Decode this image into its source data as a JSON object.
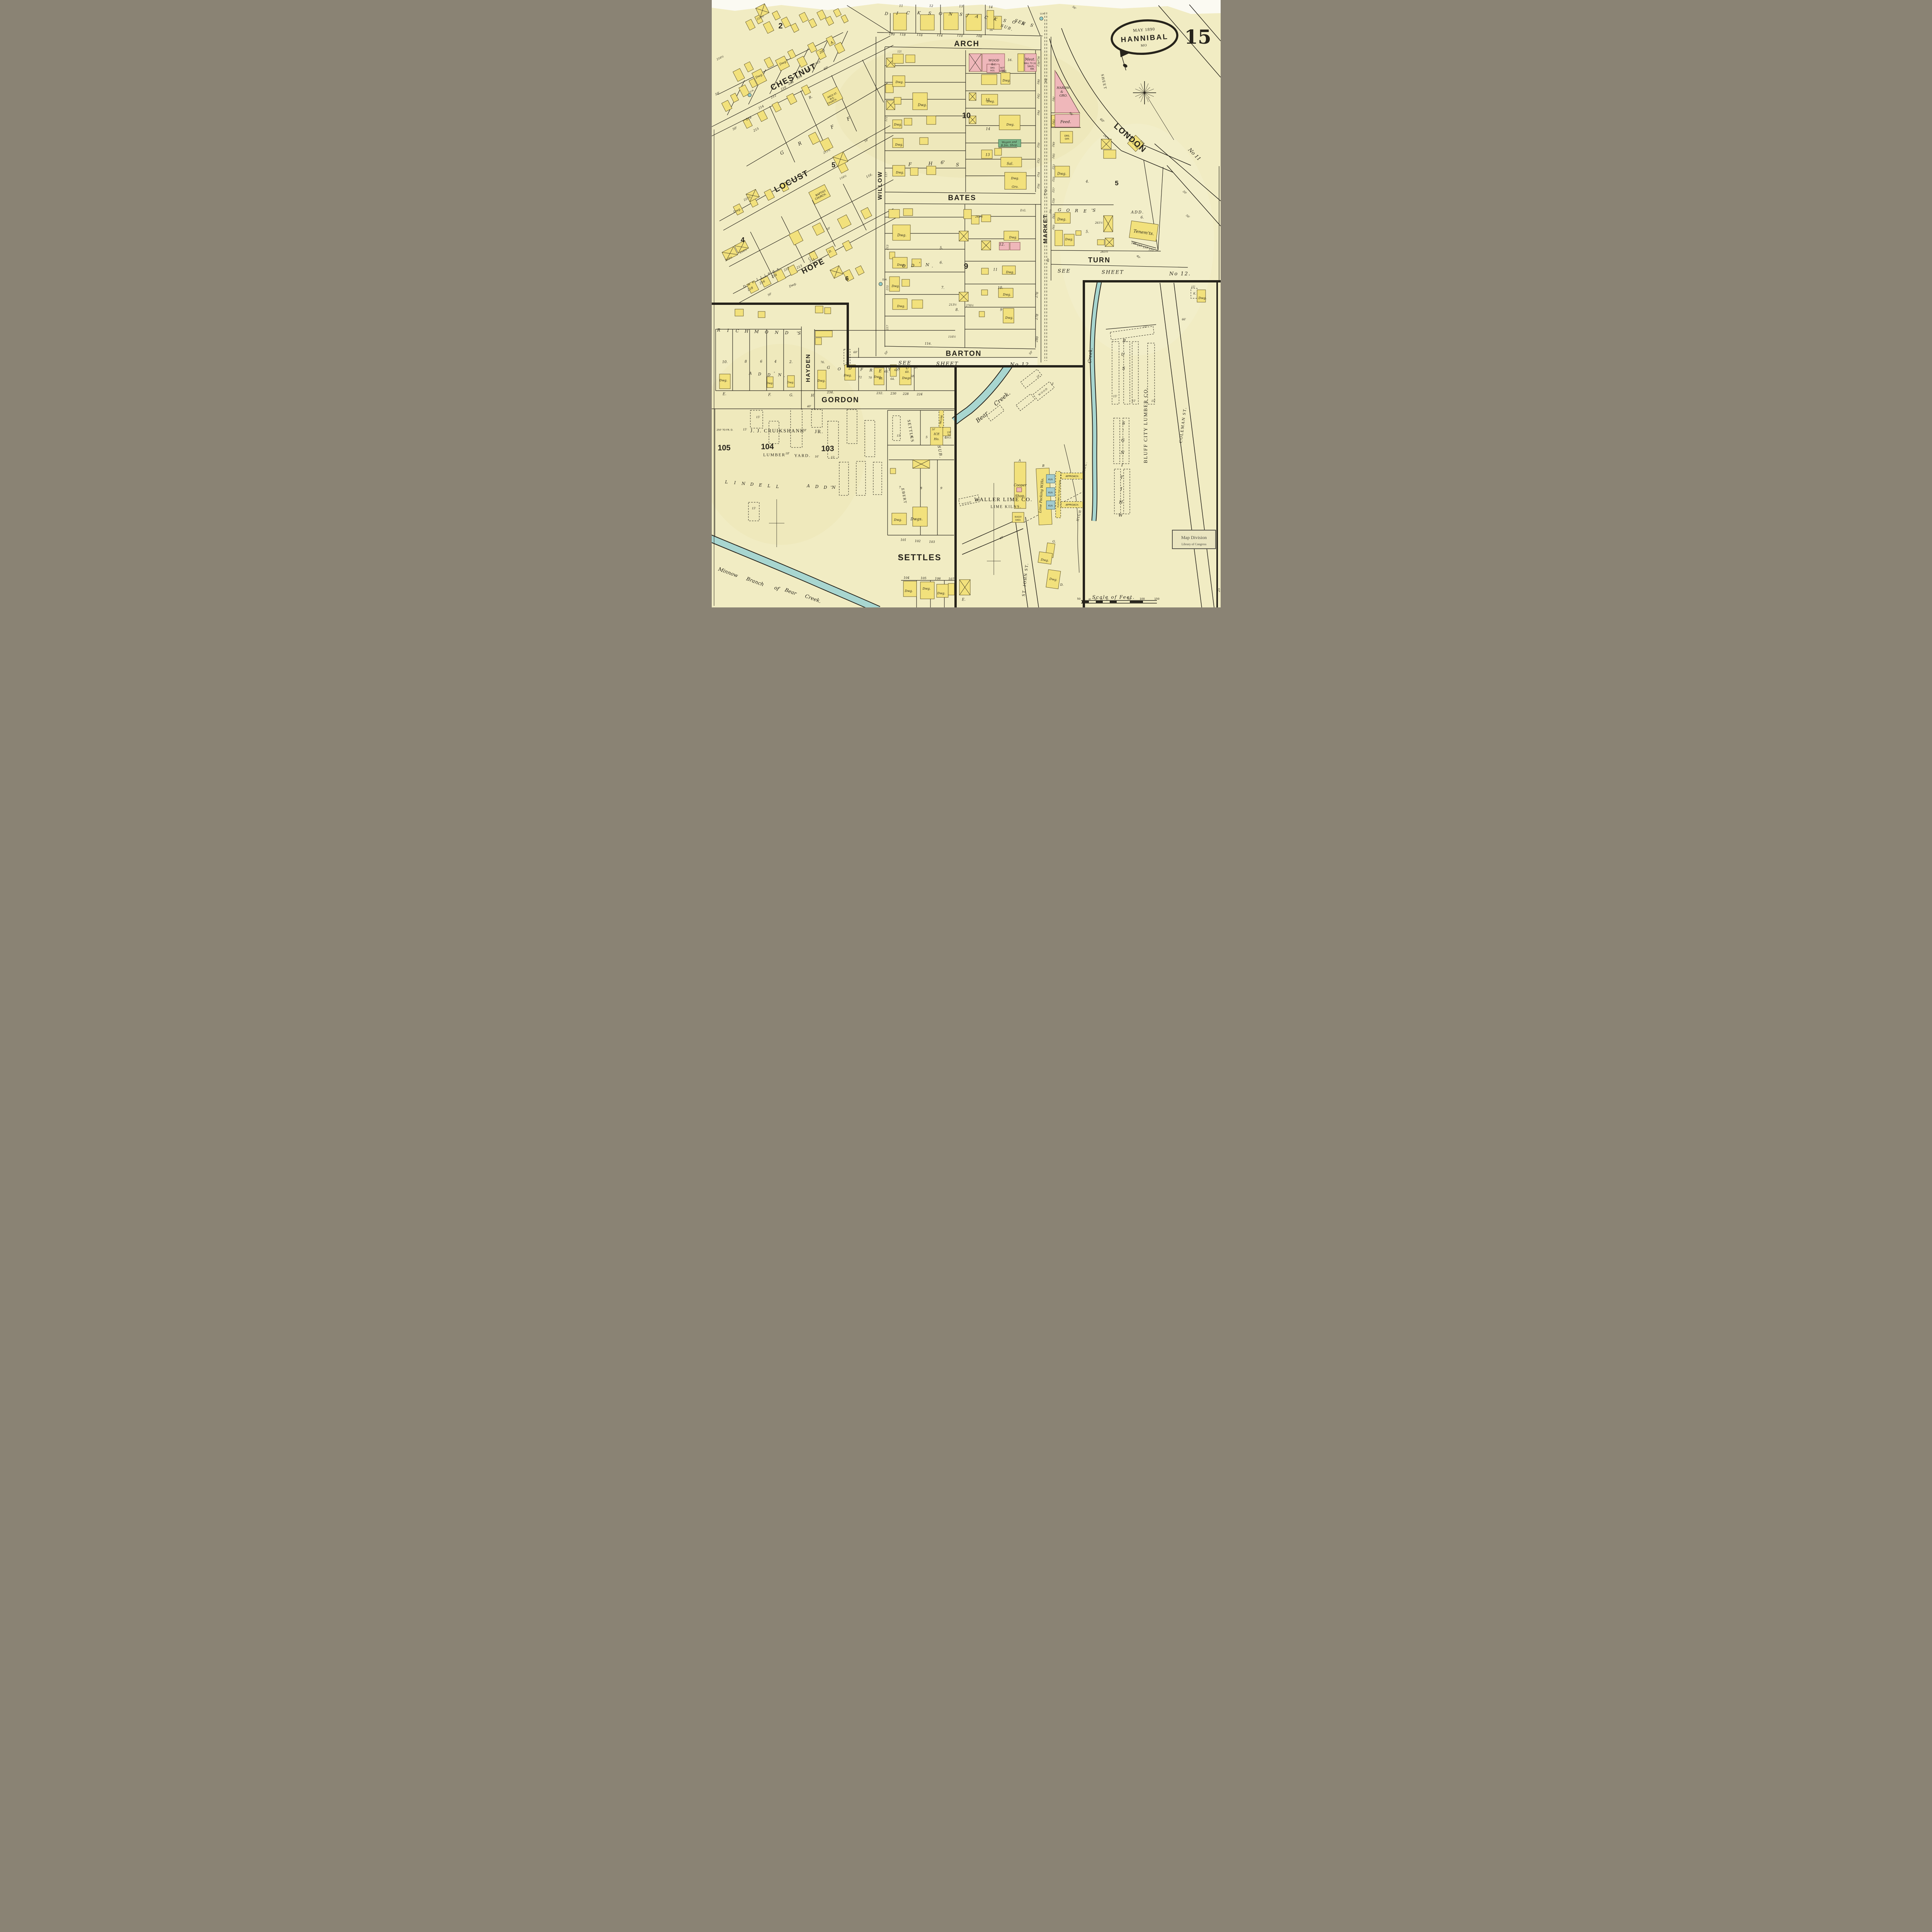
{
  "sheet": {
    "number": "15",
    "date": "MAY 1890",
    "city": "HANNIBAL",
    "state": "MO"
  },
  "streets": {
    "arch": "ARCH",
    "chestnut": "CHESTNUT",
    "locust": "LOCUST",
    "hope": "HOPE",
    "willow": "WILLOW",
    "bates": "BATES",
    "barton": "BARTON",
    "market": "MARKET",
    "london": "LONDON",
    "turn": "TURN",
    "hayden": "HAYDEN",
    "gordon": "GORDON",
    "settles": "SETTLES",
    "st_john": "ST. JOHN ST.",
    "coleman": "COLEMAN ST."
  },
  "refs": {
    "see": "SEE",
    "sheet": "SHEET",
    "no12": "No 12.",
    "no11": "No 11",
    "sheet_v": "SHEET"
  },
  "subs": {
    "dicksons": [
      "D",
      "I",
      "C",
      "K",
      "S",
      "O",
      "N",
      "S"
    ],
    "jacksons": [
      "J",
      "A",
      "C",
      "K",
      "S",
      "O",
      "N",
      "S"
    ],
    "sub": "SUB.",
    "richmonds": [
      "R",
      "I",
      "C",
      "H",
      "M",
      "O",
      "N",
      "D",
      "'S"
    ],
    "addn": [
      "A",
      "D",
      "D",
      "'",
      "N",
      "."
    ],
    "godfrey": [
      "G",
      "O",
      "D",
      "F",
      "R",
      "E",
      "Y"
    ],
    "gsub": [
      "S",
      "U",
      "B."
    ],
    "gores": [
      "G",
      "O",
      "R",
      "E",
      "'S"
    ],
    "gores_add": "ADD.",
    "gores_lot": "6.",
    "lindell": [
      "L",
      "I",
      "N",
      "D",
      "E",
      "L",
      "L"
    ],
    "laddn": [
      "A",
      "D",
      "D",
      "'N",
      "."
    ],
    "whitings": [
      "W",
      "H",
      "I",
      "T",
      "I",
      "N",
      "G",
      "'",
      "S"
    ],
    "wsub": [
      "S",
      "U",
      "B."
    ],
    "grif5": [
      "G",
      "R",
      "F",
      "F"
    ],
    "grif10": [
      "F",
      "H",
      "6'",
      "S"
    ],
    "b9addn": [
      "O",
      "D",
      "'",
      "N",
      "."
    ],
    "dwell": [
      "D",
      "w",
      "e",
      "l",
      "l",
      "i",
      "n",
      "g",
      "s."
    ],
    "settles": "SETTLES",
    "ebert": "EBERT"
  },
  "places": {
    "me": [
      "ARCH ST.",
      "M.E.",
      "CHURCH."
    ],
    "bap": [
      "BAPTIST",
      "CHURCH."
    ],
    "dwg": "Dwg.",
    "dwgs": "Dwgs.",
    "dg": "D.G.",
    "sal": "Sal.",
    "gro": "Gro.",
    "meat": "Meat.",
    "saus": "SAUS.,",
    "rm": "RM.",
    "wood1": "WOOD",
    "wood2": "&c.",
    "smo1": "SMO.",
    "smo2": "HOS.",
    "nu1": "NOT",
    "nu2": "USED",
    "hardw": [
      "HARDW.",
      "&",
      "GRO."
    ],
    "feed": "Feed.",
    "drs": [
      "DRS.",
      "OFF."
    ],
    "wagon": "Wagon and",
    "bsm": "B.Sm. Shop.",
    "tenem": "Tenem'ts.",
    "waller": "WALLER LIME CO.",
    "kilns": "LIME KILNS.",
    "cooper": [
      "Cooper",
      "Shop."
    ],
    "buggy": [
      "BUGGY",
      "SHED."
    ],
    "limepack": "Lime Packing W.Ho.",
    "kiln": "KILN.",
    "platform": "PLATFORM TO TOP OF KILNS.",
    "approach": "APPROACH.",
    "ice": [
      "ICE",
      "Ho."
    ],
    "incline": "INCLINE",
    "cruik": "J. J. CRUIKSHANK",
    "jr": "JR.",
    "lumber": "LUMBER",
    "yard": "YARD.",
    "bluff": "BLUFF CITY LUMBER CO.",
    "bear": "Bear",
    "creekw": "Creek."
  },
  "blocks": {
    "b2": "2",
    "b5": "5",
    "b4": "4",
    "b6": "6",
    "b10": "10",
    "b9": "9",
    "b5e": "5",
    "b103": "103",
    "b104": "104",
    "b105": "105"
  },
  "letters": {
    "a": "A.",
    "b": "B.",
    "c": "C.",
    "d": "D.",
    "e": "E.",
    "f": "F.",
    "g": "G.",
    "h": "H.",
    "a2": "A",
    "b2": "B",
    "k": "K."
  },
  "nums": {
    "dlots": [
      "11",
      "12",
      "13",
      "14"
    ],
    "arch": [
      "120",
      "118",
      "116",
      "114",
      "110",
      "108"
    ],
    "chestnut": [
      "200",
      "202",
      "204",
      "208",
      "210",
      "212",
      "214",
      "216"
    ],
    "hope_n": [
      "218",
      "216",
      "214",
      "212"
    ],
    "hope_s": [
      "213",
      "211"
    ],
    "b10e": [
      "16",
      "15",
      "14",
      "13"
    ],
    "mktw": [
      "236",
      "238",
      "240",
      "242",
      "244",
      "250",
      "252",
      "254",
      "256"
    ],
    "mkte": [
      "241",
      "243",
      "249",
      "245",
      "253",
      "255",
      "257",
      "259",
      "263",
      "265"
    ],
    "b9w": [
      "5.",
      "6.",
      "7.",
      "8."
    ],
    "b9e": [
      "12.",
      "11",
      "10.",
      "9"
    ],
    "b9r": [
      "276",
      "278",
      "280"
    ],
    "willow_s": [
      "213",
      "215",
      "217"
    ],
    "tenem": [
      "109",
      "111",
      "113",
      "115"
    ],
    "rich": [
      "10.",
      "8",
      "6",
      "4",
      "2."
    ],
    "god": [
      "76.",
      "74.",
      "72",
      "70",
      "68.",
      "66.",
      "64.",
      "62.",
      "60.",
      "58."
    ],
    "gordon": [
      "234.",
      "232.",
      "230",
      "228",
      "224"
    ],
    "ssub": [
      "101",
      "102",
      "103"
    ],
    "sst": [
      "104",
      "105",
      "106",
      "107"
    ],
    "d10": "10'",
    "d15": "15'",
    "d16": "16'",
    "d18": "18'",
    "d20": "20'",
    "d25": "25",
    "d40": "40'",
    "d50": "50'",
    "d56": "56'",
    "d60": "60'",
    "d66": "66'",
    "c216h": "216½",
    "c210h": "210½",
    "l211h": "211½",
    "l116h": "116½",
    "l116": "116.",
    "l215": "215",
    "h225": "225½",
    "h218": "218½",
    "h216": "216½",
    "h261": "261½",
    "h265": "265½",
    "h247": "247½",
    "b9h213": "213½",
    "b9h276": "276½",
    "b9h262": "262½",
    "l121": "121",
    "l16d": "16.",
    "l118": "118",
    "w111": "111",
    "w117": "117",
    "l201": "201",
    "g4": "4.",
    "g5": "5.",
    "s4": "4.",
    "s5": "5",
    "s6": "6",
    "s7": "7.",
    "s8": "8",
    "s9": "9"
  },
  "notes": {
    "uh": "U.H.",
    "dh": "D.H.",
    "wp6": "6\"W.P.",
    "wp8": "8\"W.P.",
    "wood": "WOOD",
    "high": "HIGH",
    "hill": "HILL.",
    "frd250": "250' TO FR. D.",
    "frd130": [
      "130'",
      "TO.",
      "FR.D."
    ],
    "wall2": "WALL TO 2d."
  },
  "minnow": [
    "Minnow",
    "Branch",
    "of",
    "Bear",
    "Creek."
  ],
  "scale": {
    "title": "Scale of Feet.",
    "ticks": [
      "50",
      "40",
      "30",
      "20",
      "10",
      "50",
      "100",
      "150"
    ]
  },
  "stamp": {
    "l1": "Map Division",
    "l2": "Library of Congress"
  }
}
